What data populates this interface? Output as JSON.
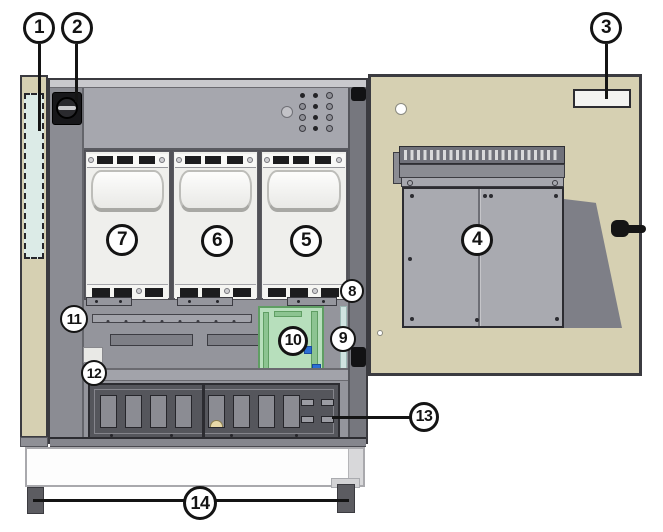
{
  "figure": {
    "type": "equipment-cabinet-parts-diagram",
    "description": "Power cabinet with three plug-in modules, open door with mounted unit, numbered part callouts"
  },
  "callouts": [
    {
      "label": "1"
    },
    {
      "label": "2"
    },
    {
      "label": "3"
    },
    {
      "label": "4"
    },
    {
      "label": "5"
    },
    {
      "label": "6"
    },
    {
      "label": "7"
    },
    {
      "label": "8"
    },
    {
      "label": "9"
    },
    {
      "label": "10"
    },
    {
      "label": "11"
    },
    {
      "label": "12"
    },
    {
      "label": "13"
    },
    {
      "label": "14"
    }
  ],
  "colors": {
    "door_tan": "#d6d0b2",
    "interior_gray": "#94959c",
    "module_white": "#efefec",
    "dashed_panel_blue": "#dcebe7",
    "pcb_green": "#b7dfbc",
    "pcb_chip_blue": "#2b6fd4",
    "signal_strip_blue": "#cfe3e0",
    "breaker_panel_dark": "#55565c",
    "callout_fill": "#ffffff",
    "outline_black": "#141414"
  },
  "icons": {
    "rotary_switch": "rotary-switch-icon",
    "door_handle": "door-handle-icon",
    "hinge": "hinge-icon"
  }
}
